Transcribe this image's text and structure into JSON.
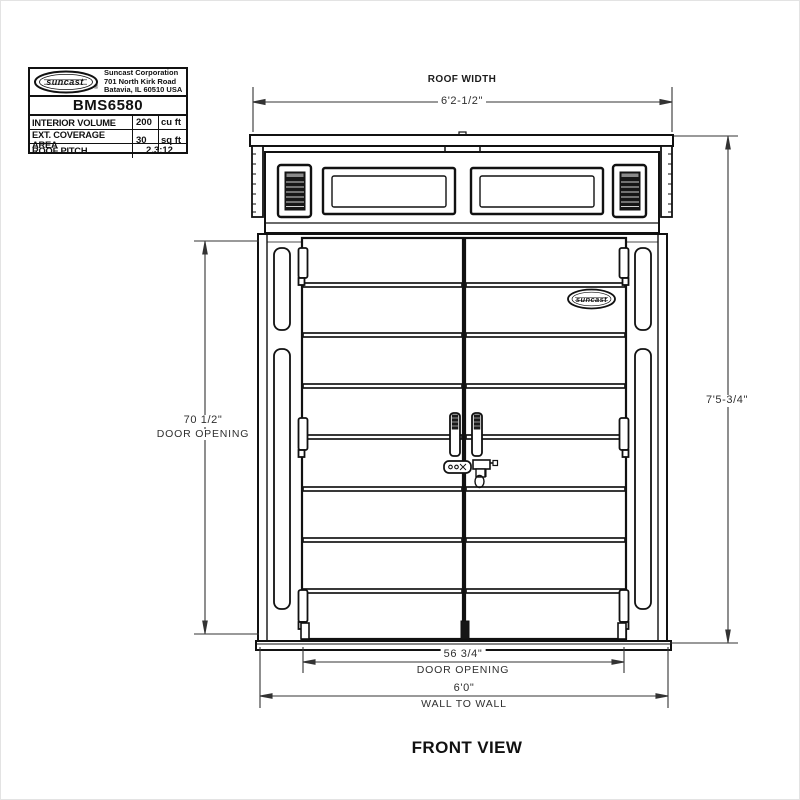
{
  "title_block": {
    "logo": "suncast",
    "reg_mark": "®",
    "address_line1": "Suncast Corporation",
    "address_line2": "701 North Kirk Road",
    "address_line3": "Batavia, IL 60510 USA",
    "model": "BMS6580",
    "specs": [
      {
        "label": "INTERIOR VOLUME",
        "value": "200",
        "unit": "cu ft"
      },
      {
        "label": "EXT. COVERAGE AREA",
        "value": "30",
        "unit": "sq ft"
      },
      {
        "label": "ROOF PITCH",
        "value": "2.3:12",
        "unit": ""
      }
    ]
  },
  "dims": {
    "roof_width_label": "ROOF WIDTH",
    "roof_width_value": "6'2-1/2\"",
    "overall_height_value": "7'5-3/4\"",
    "door_height_value": "70 1/2\"",
    "door_height_label": "DOOR OPENING",
    "door_width_value": "56 3/4\"",
    "door_width_label": "DOOR OPENING",
    "wall_value": "6'0\"",
    "wall_label": "WALL TO WALL"
  },
  "shed": {
    "badge": "suncast"
  },
  "view_label": "FRONT VIEW",
  "colors": {
    "line": "#111111",
    "dim": "#333333",
    "vent_fill": "#161616"
  }
}
